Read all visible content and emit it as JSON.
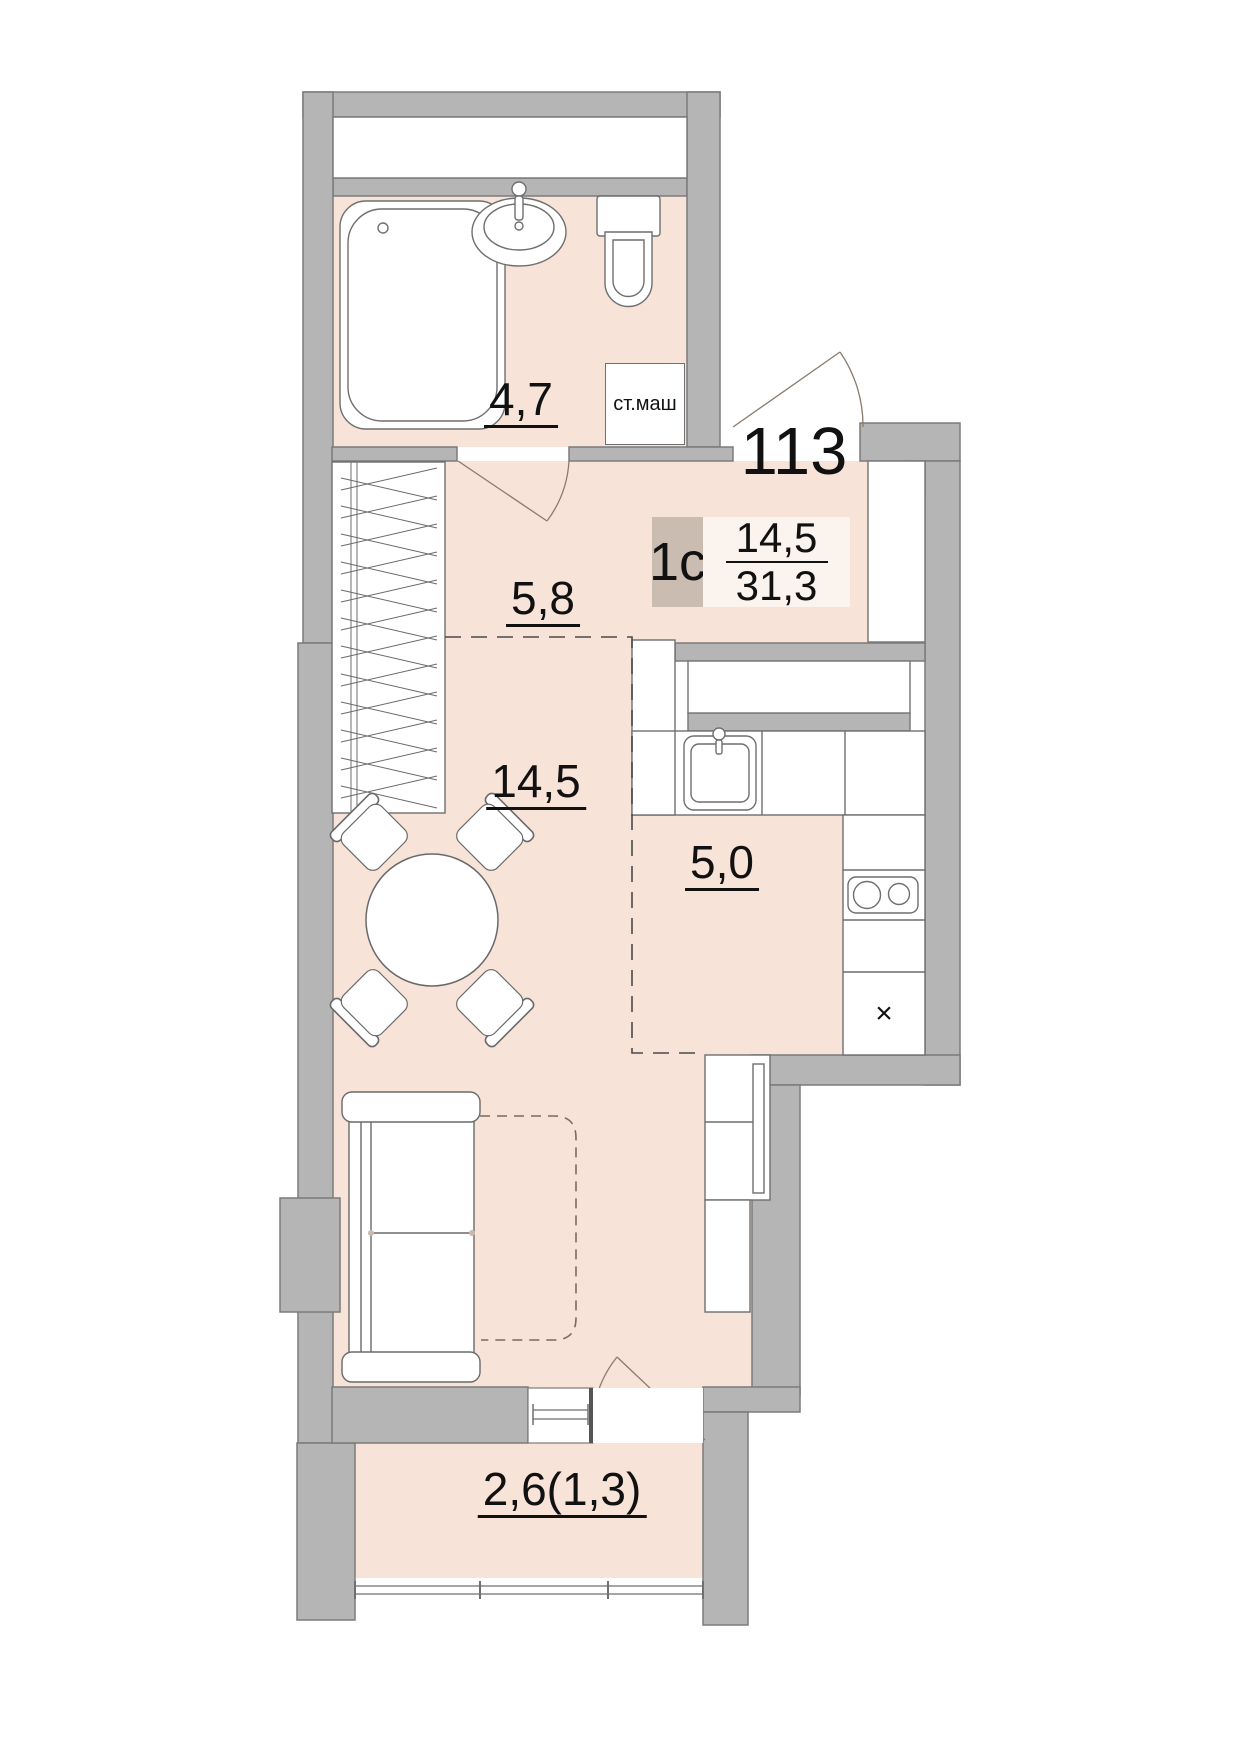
{
  "plan": {
    "apartment_number": "113",
    "type_label": "1с",
    "living_area": "14,5",
    "total_area": "31,3",
    "rooms": {
      "bathroom": {
        "area": "4,7"
      },
      "hallway": {
        "area": "5,8"
      },
      "living": {
        "area": "14,5"
      },
      "kitchen": {
        "area": "5,0"
      },
      "balcony": {
        "area": "2,6(1,3)"
      }
    },
    "washing_machine_label": "ст.маш",
    "fridge_symbol": "×",
    "colors": {
      "wall": "#b5b5b5",
      "wall_outline": "#7b7b7b",
      "floor": "#f7e3d8",
      "type_box": "#cbbcb1",
      "area_box": "#faf3ee",
      "text": "#111111"
    },
    "icons": [
      "bathtub-icon",
      "bath-sink-icon",
      "toilet-icon",
      "washing-machine-icon",
      "wardrobe-icon",
      "door-swing-icon",
      "dining-table-icon",
      "chair-icon",
      "sofa-icon",
      "sofa-bed-outline-icon",
      "kitchen-sink-icon",
      "stove-icon",
      "fridge-cross-icon",
      "window-icon",
      "balcony-glazing-icon"
    ]
  }
}
